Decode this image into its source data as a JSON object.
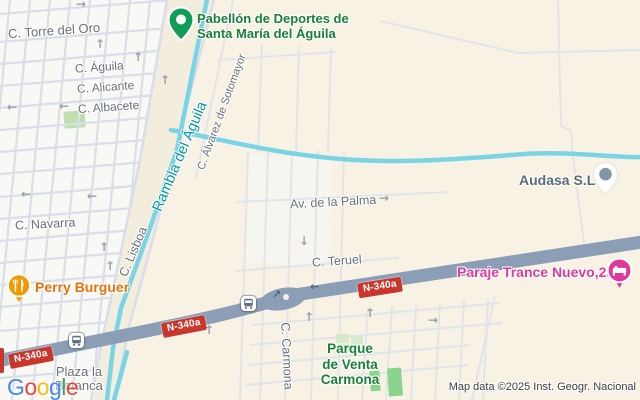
{
  "attribution": "Map data ©2025 Inst. Geogr. Nacional",
  "logo": {
    "letters": [
      {
        "ch": "G",
        "color": "#4285F4"
      },
      {
        "ch": "o",
        "color": "#EA4335"
      },
      {
        "ch": "o",
        "color": "#FBBC05"
      },
      {
        "ch": "g",
        "color": "#4285F4"
      },
      {
        "ch": "l",
        "color": "#34A853"
      },
      {
        "ch": "e",
        "color": "#EA4335"
      }
    ]
  },
  "colors": {
    "land_beige": "#F7F2E4",
    "urban_light": "#F8F8F5",
    "street_line": "#D9DEE8",
    "water_cyan": "#7AD4E6",
    "highway": "#8C9DB6",
    "shield_red": "#C9372C",
    "street_label": "#6A717B",
    "rambla_teal": "#0097A7",
    "poi_green": "#188038",
    "poi_orange": "#E8710A",
    "poi_pink": "#DE3A9B",
    "poi_slate": "#5B6B79",
    "park_green": "#BDE0AE"
  },
  "streets": {
    "torre_del_oro": "C. Torre del Oro",
    "aguila": "C. Águila",
    "alicante": "C. Alicante",
    "albacete": "C. Albacete",
    "navarra": "C. Navarra",
    "lisboa": "C. Lisboa",
    "rambla": "Rambla del Águila",
    "alvarez_sotomayor": "C. Álvarez de Sotomayor",
    "av_palma": "Av. de la Palma",
    "teruel": "C. Teruel",
    "carmona": "C. Carmona"
  },
  "road_shield": {
    "label": "N-340a"
  },
  "places": {
    "pabellon": {
      "line1": "Pabellón de Deportes de",
      "line2": "Santa María del Águila"
    },
    "perry": {
      "label": "Perry Burguer"
    },
    "audasa": {
      "label": "Audasa S.L"
    },
    "paraje": {
      "label": "Paraje Trance Nuevo,23"
    },
    "parque_venta": {
      "line1": "Parque",
      "line2": "de Venta",
      "line3": "Carmona"
    },
    "plaza_betanca": {
      "line1": "Plaza la",
      "line2": "Betanca"
    }
  },
  "icons": {
    "arrow_up": "↑",
    "arrow_down": "↓",
    "arrow_left": "←",
    "arrow_right": "→",
    "arrow_up_right": "↗"
  }
}
